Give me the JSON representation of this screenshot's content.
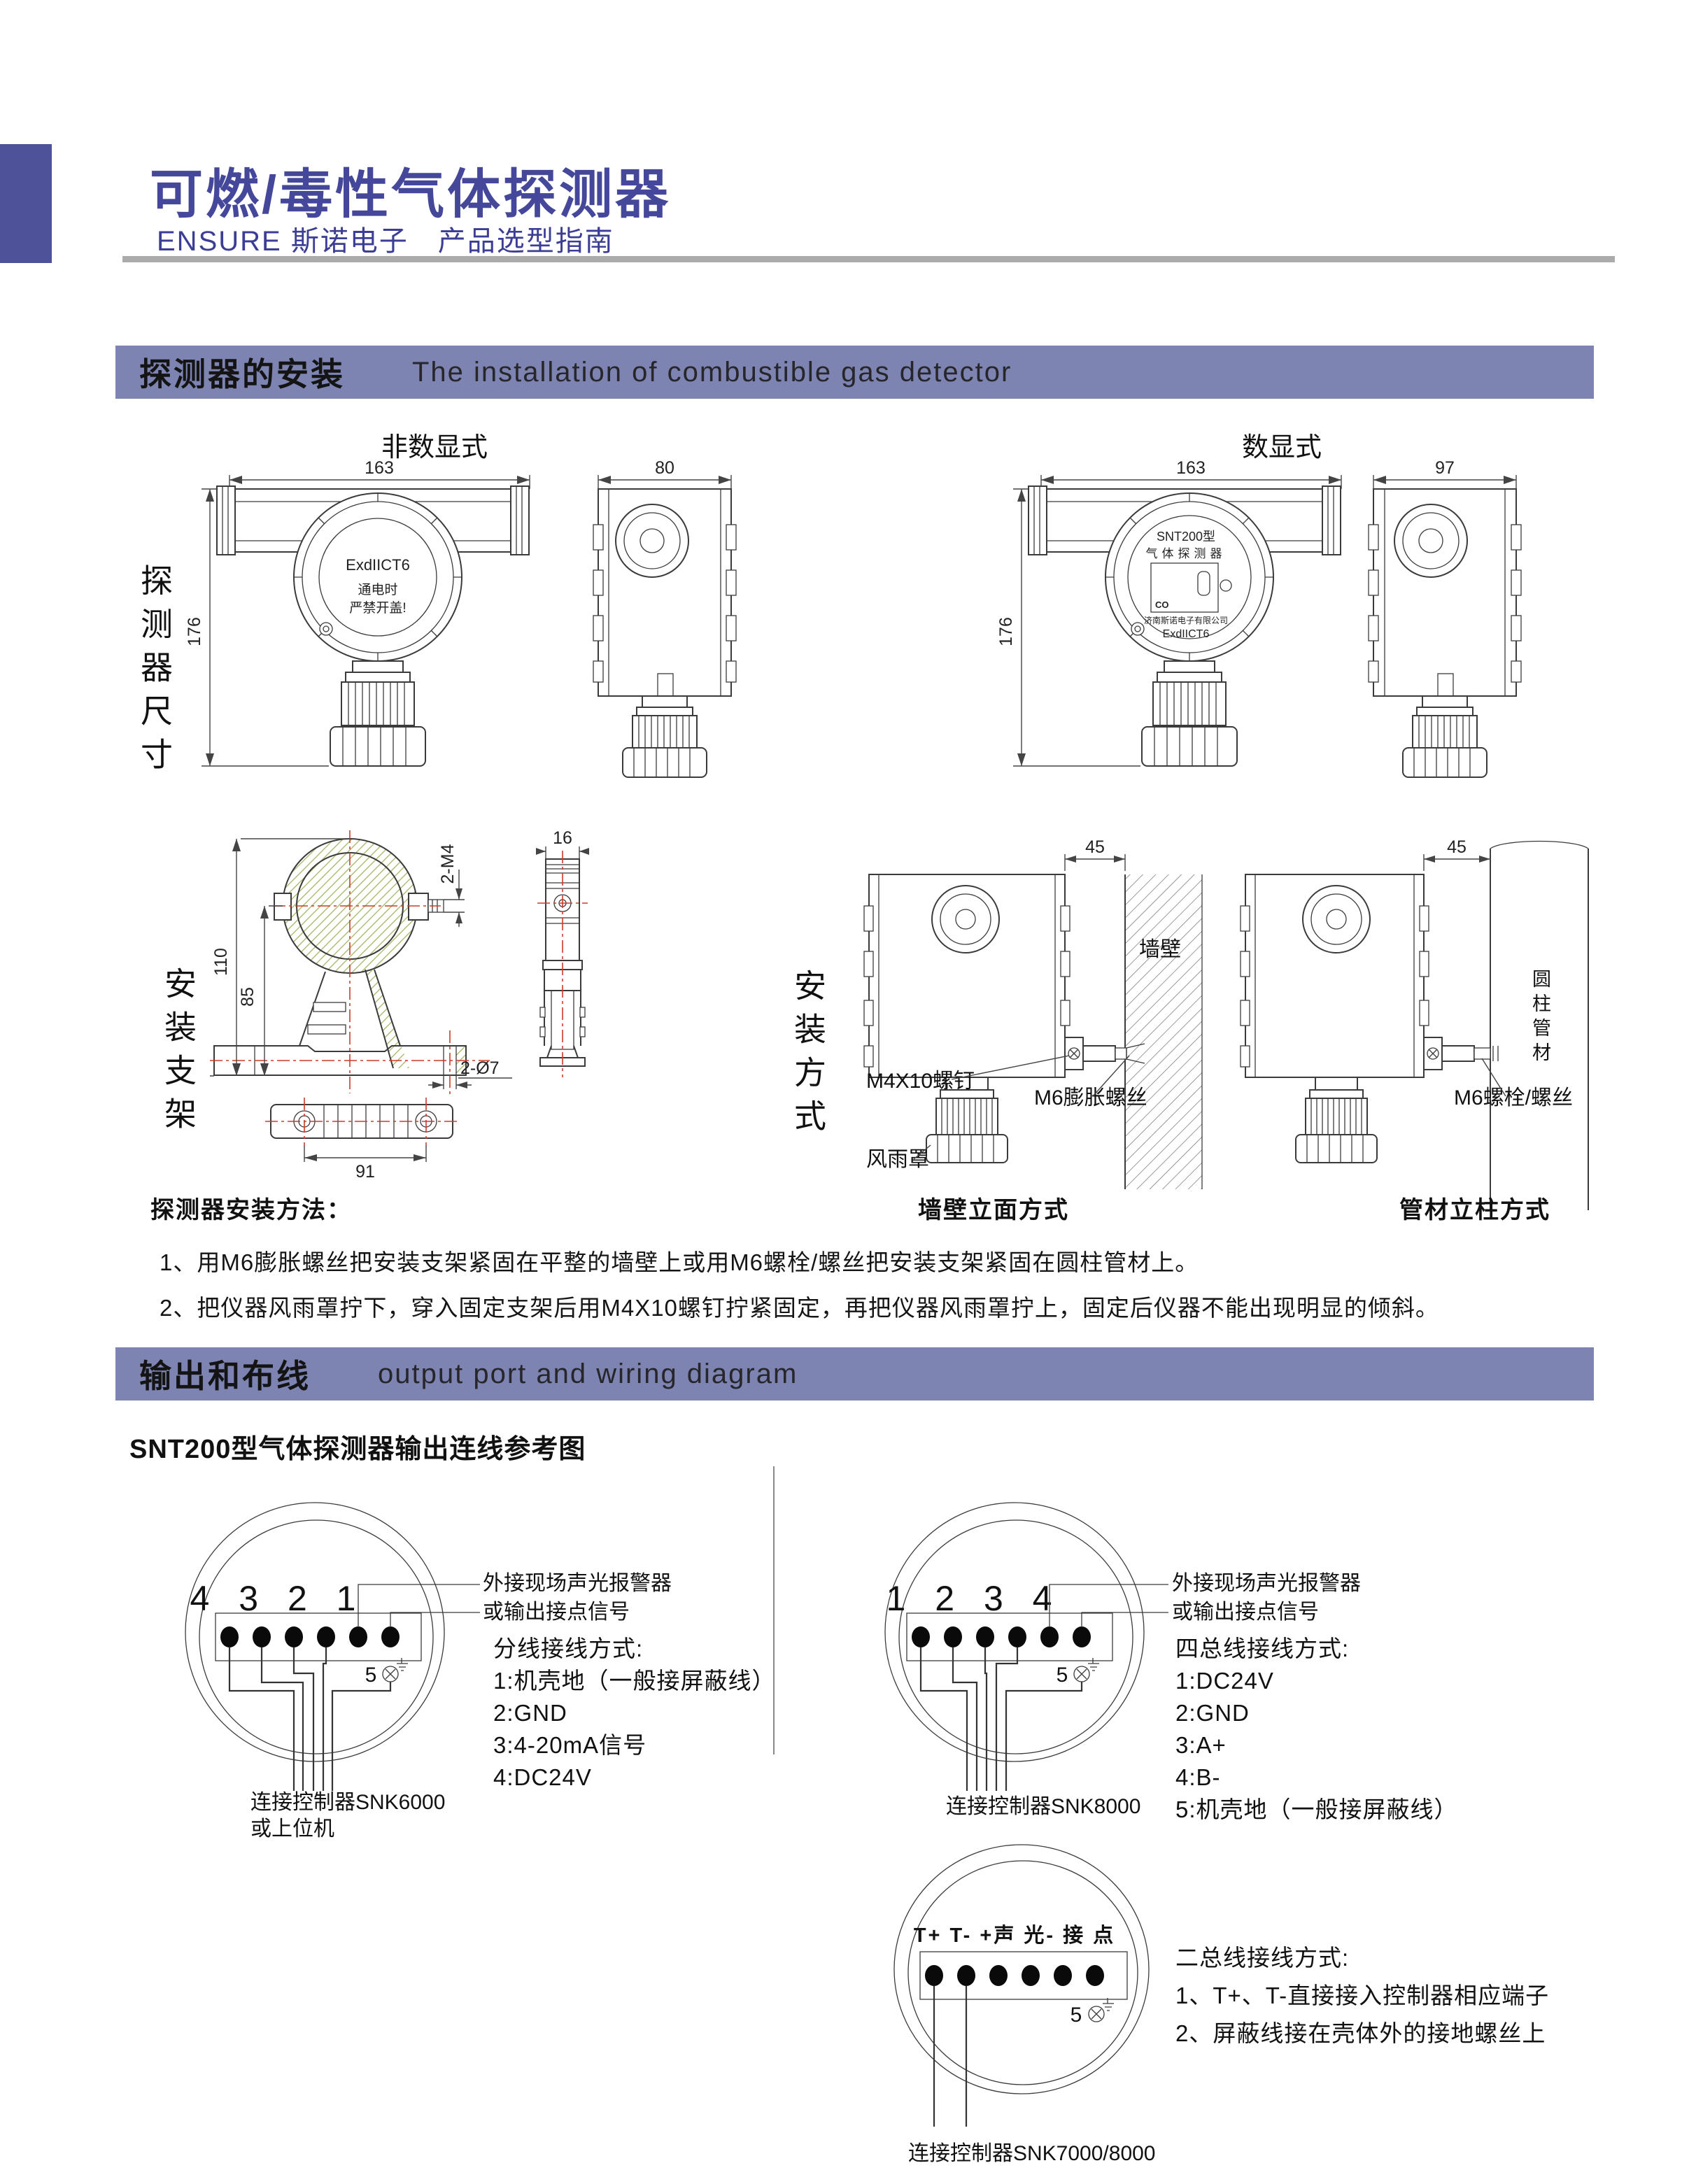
{
  "header": {
    "title": "可燃/毒性气体探测器",
    "subtitle": "ENSURE 斯诺电子　产品选型指南"
  },
  "sections": {
    "install": {
      "zh": "探测器的安装",
      "en": "The installation of combustible gas detector"
    },
    "output": {
      "zh": "输出和布线",
      "en": "output port and wiring diagram"
    }
  },
  "detector_dims": {
    "row_label": "探测器尺寸",
    "non_digital_label": "非数显式",
    "digital_label": "数显式",
    "nd_front": {
      "w": "163",
      "h": "176",
      "l1": "ExdIICT6",
      "l2": "通电时",
      "l3": "严禁开盖!"
    },
    "nd_side": {
      "w": "80"
    },
    "d_front": {
      "w": "163",
      "h": "176",
      "model": "SNT200型",
      "name": "气体探测器",
      "gas": "CO",
      "company": "济南斯诺电子有限公司",
      "cert": "ExdIICT6"
    },
    "d_side": {
      "w": "97"
    }
  },
  "bracket": {
    "row_label": "安装支架",
    "dim_height": "110",
    "dim_inner": "85",
    "dim_screw": "2-M4",
    "dim_side_w": "16",
    "dim_hole": "2-Ø7",
    "dim_base_w": "91"
  },
  "mounting": {
    "row_label": "安装方式",
    "wall": {
      "dim": "45",
      "surface": "墙壁",
      "screw": "M4X10螺钉",
      "anchor": "M6膨胀螺丝",
      "cover": "风雨罩",
      "caption": "墙壁立面方式"
    },
    "pipe": {
      "dim": "45",
      "surface": "圆柱管材",
      "bolt": "M6螺栓/螺丝",
      "caption": "管材立柱方式"
    }
  },
  "install_method": {
    "heading": "探测器安装方法：",
    "item1": "1、用M6膨胀螺丝把安装支架紧固在平整的墙壁上或用M6螺栓/螺丝把安装支架紧固在圆柱管材上。",
    "item2": "2、把仪器风雨罩拧下，穿入固定支架后用M4X10螺钉拧紧固定，再把仪器风雨罩拧上，固定后仪器不能出现明显的倾斜。"
  },
  "wiring": {
    "heading": "SNT200型气体探测器输出连线参考图",
    "note1": "外接现场声光报警器",
    "note2": "或输出接点信号",
    "d1": {
      "terminals": "4 3 2 1",
      "gnd": "5",
      "title": "分线接线方式:",
      "items": [
        "1:机壳地（一般接屏蔽线）",
        "2:GND",
        "3:4-20mA信号",
        "4:DC24V"
      ],
      "ctrl1": "连接控制器SNK6000",
      "ctrl2": "或上位机"
    },
    "d2": {
      "terminals": "1 2 3 4",
      "gnd": "5",
      "title": "四总线接线方式:",
      "items": [
        "1:DC24V",
        "2:GND",
        "3:A+",
        "4:B-",
        "5:机壳地（一般接屏蔽线）"
      ],
      "ctrl": "连接控制器SNK8000"
    },
    "d3": {
      "terminals": "T+ T-  +声 光-  接 点",
      "gnd": "5",
      "title": "二总线接线方式:",
      "items": [
        "1、T+、T-直接接入控制器相应端子",
        "2、屏蔽线接在壳体外的接地螺丝上"
      ],
      "ctrl": "连接控制器SNK7000/8000"
    }
  }
}
